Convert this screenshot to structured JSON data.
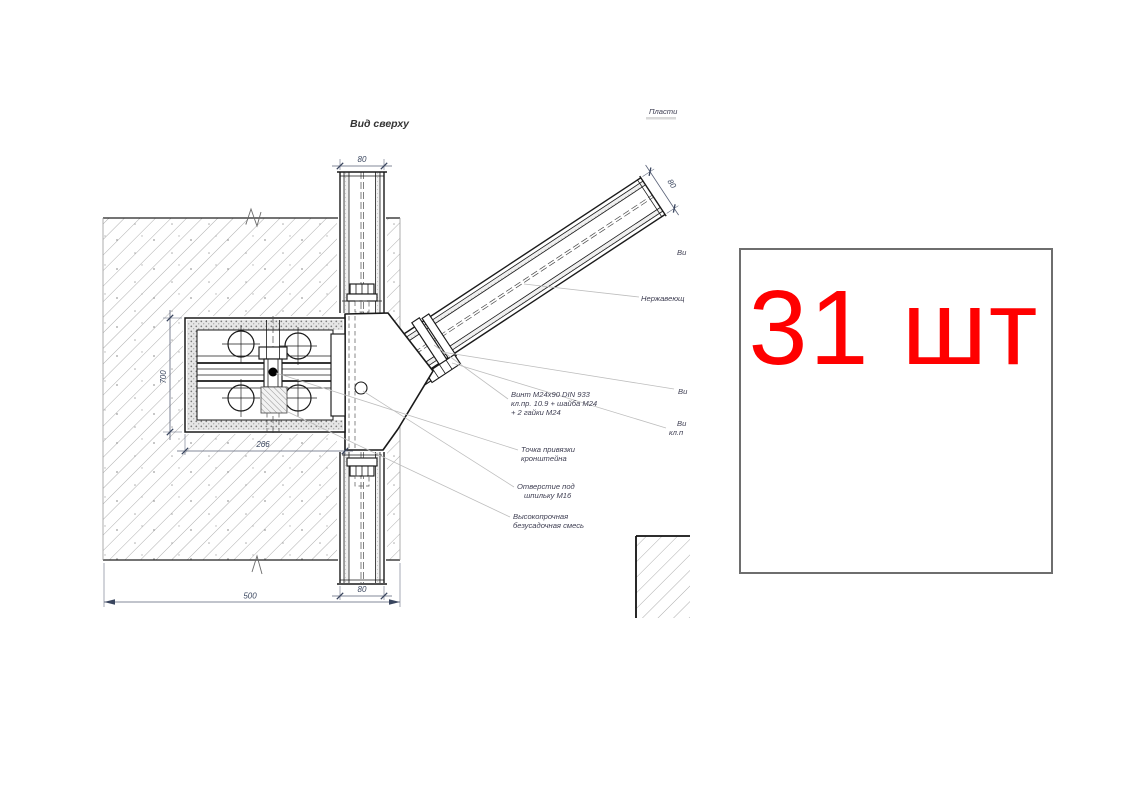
{
  "drawing": {
    "view_title": "Вид сверху",
    "dims": {
      "top_beam": "80",
      "bottom_beam": "80",
      "diag_beam": "80",
      "wall_width": "500",
      "bracket_width": "266",
      "bracket_height": "700"
    },
    "annotations": {
      "screw_l1": "Винт М24х90 DIN 933",
      "screw_l2": "кл.пр. 10.9 + шайба М24",
      "screw_l3": "+ 2 гайки М24",
      "anchor_l1": "Точка привязки",
      "anchor_l2": "кронштейна",
      "hole_l1": "Отверстие под",
      "hole_l2": "шпильку М16",
      "grout_l1": "Высокопрочная",
      "grout_l2": "безусадочная смесь"
    },
    "edge_labels": {
      "plate_partial": "Пласти",
      "stainless_partial": "Нержавеющ",
      "view_partial_1": "Ви",
      "view_partial_2": "Ви",
      "view_partial_3": "Ви",
      "class_partial": "кл.п"
    }
  },
  "callout": {
    "quantity": "31 шт",
    "color": "#ff0000",
    "border_color": "#6e6e6e"
  }
}
